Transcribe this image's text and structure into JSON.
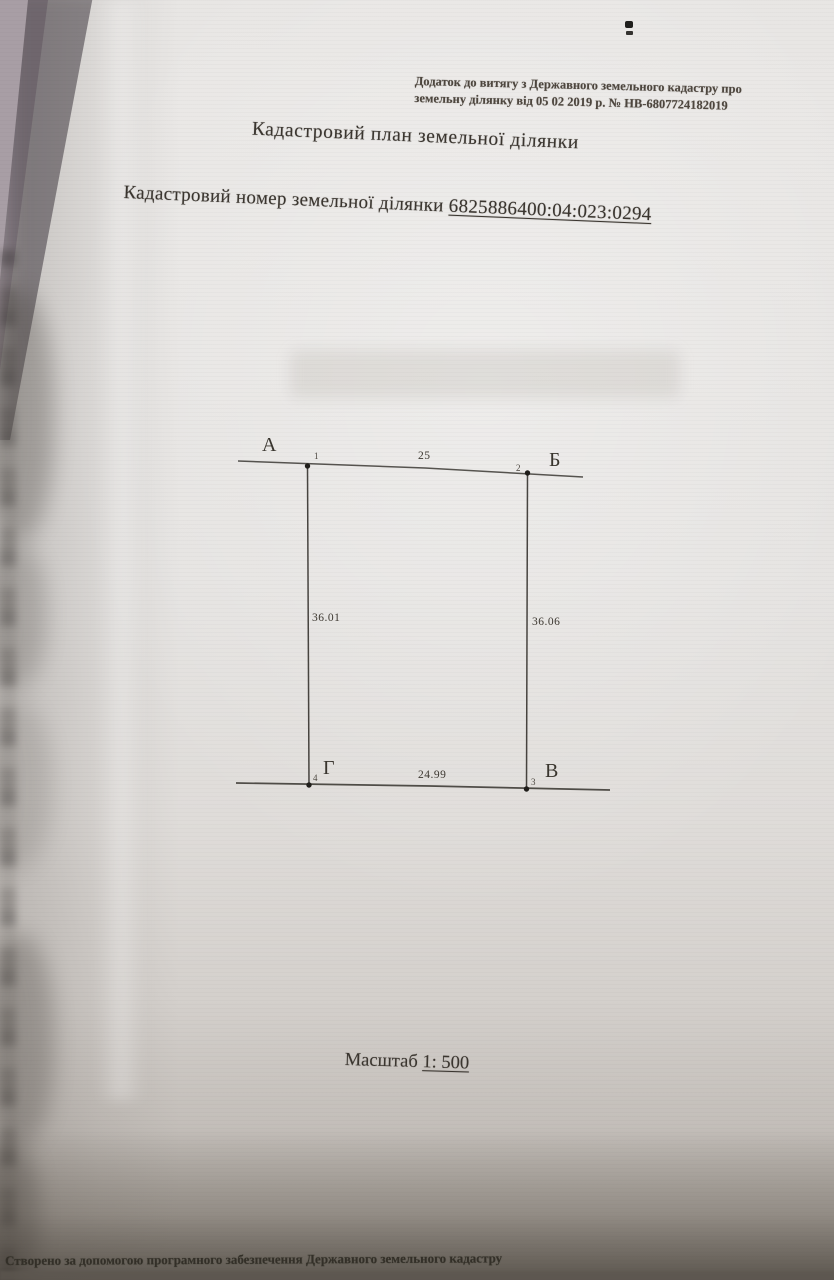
{
  "document": {
    "header_note_line1": "Додаток до витягу з Державного земельного кадастру про",
    "header_note_line2": "земельну ділянку від 05 02 2019 р. № НВ-6807724182019",
    "title": "Кадастровий план земельної ділянки",
    "cadastral_label": "Кадастровий номер земельної ділянки ",
    "cadastral_number": "6825886400:04:023:0294",
    "scale_label": "Масштаб ",
    "scale_value": "1: 500",
    "footer": "Створено за допомогою програмного забезпечення Державного земельного кадастру"
  },
  "plot": {
    "corner_a": {
      "letter": "А",
      "vertex": "1"
    },
    "corner_b": {
      "letter": "Б",
      "vertex": "2"
    },
    "corner_v": {
      "letter": "В",
      "vertex": "3"
    },
    "corner_g": {
      "letter": "Г",
      "vertex": "4"
    },
    "side_top": "25",
    "side_right": "36.06",
    "side_bottom": "24.99",
    "side_left": "36.01"
  },
  "colors": {
    "ink": "#39352e",
    "paper": "#e6e4e2",
    "backdrop": "#a89ea5"
  }
}
